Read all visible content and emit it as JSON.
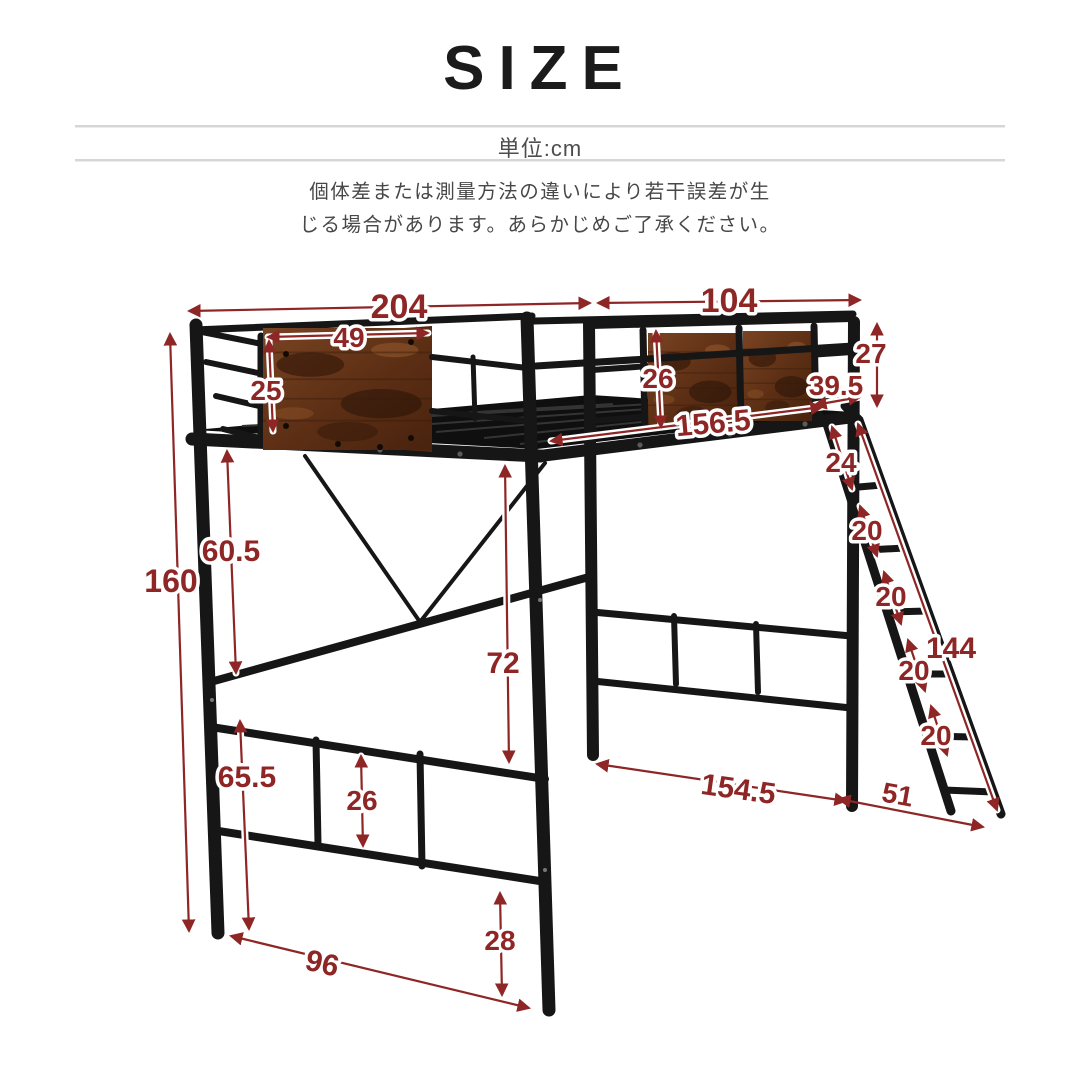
{
  "header": {
    "title": "SIZE",
    "unit_label": "単位:cm",
    "note_line1": "個体差または測量方法の違いにより若干誤差が生",
    "note_line2": "じる場合があります。あらかじめご了承ください。"
  },
  "colors": {
    "dimension_red": "#8e2626",
    "frame_black": "#161616",
    "wood_brown": "#6d3a1d",
    "note_gray": "#474747",
    "divider_gray": "#d6d6d6"
  },
  "diagram": {
    "type": "loft-bed-size-diagram",
    "subject": "metal loft bed with wood panels and ladder",
    "dimensions": [
      {
        "id": "bed-length-top",
        "value": "204"
      },
      {
        "id": "bed-width-top",
        "value": "104"
      },
      {
        "id": "headboard-panel-width",
        "value": "49"
      },
      {
        "id": "headboard-panel-height",
        "value": "25"
      },
      {
        "id": "rear-guard-height",
        "value": "26"
      },
      {
        "id": "guard-above-deck",
        "value": "27"
      },
      {
        "id": "ladder-top-offset",
        "value": "39.5"
      },
      {
        "id": "side-rail-length",
        "value": "156.5"
      },
      {
        "id": "ladder-top-gap",
        "value": "24"
      },
      {
        "id": "ladder-step-1",
        "value": "20"
      },
      {
        "id": "ladder-step-2",
        "value": "20"
      },
      {
        "id": "ladder-step-3",
        "value": "20"
      },
      {
        "id": "ladder-step-4",
        "value": "20"
      },
      {
        "id": "ladder-length",
        "value": "144"
      },
      {
        "id": "total-height",
        "value": "160"
      },
      {
        "id": "upper-clearance",
        "value": "60.5"
      },
      {
        "id": "under-bed-clearance",
        "value": "72"
      },
      {
        "id": "footboard-height",
        "value": "65.5"
      },
      {
        "id": "footboard-panel-height",
        "value": "26"
      },
      {
        "id": "under-bed-depth",
        "value": "154.5"
      },
      {
        "id": "ladder-floor-offset",
        "value": "51"
      },
      {
        "id": "front-leg-span",
        "value": "96"
      },
      {
        "id": "lower-rail-height",
        "value": "28"
      }
    ]
  }
}
